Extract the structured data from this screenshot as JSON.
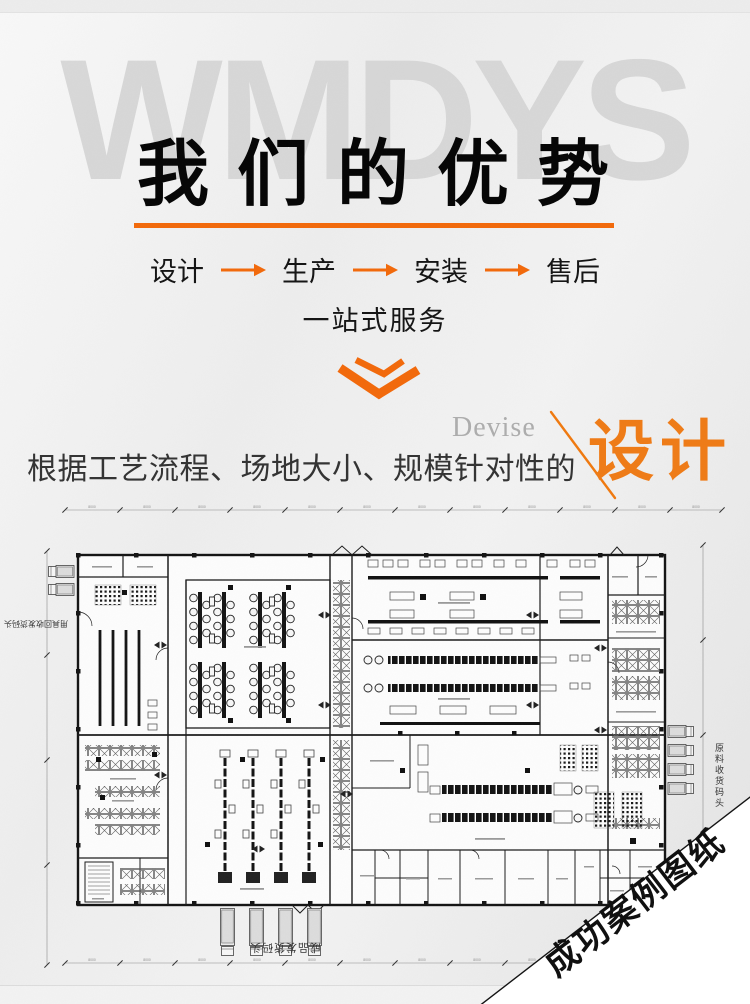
{
  "page": {
    "watermark": "WMDYS"
  },
  "header": {
    "title": "我 们 的 优 势"
  },
  "flow": {
    "steps": [
      "设计",
      "生产",
      "安装",
      "售后"
    ],
    "subtitle": "一站式服务"
  },
  "design_section": {
    "english": "Devise",
    "keyword": "设计",
    "description": "根据工艺流程、场地大小、规模针对性的"
  },
  "plan": {
    "dim_label": "8000",
    "docks": {
      "right": "原料收货码头",
      "left": "用具回收发货码头",
      "bottom": "成品发货码头"
    }
  },
  "ribbon": {
    "text": "成功案例图纸"
  },
  "colors": {
    "accent": "#f2690b",
    "keyword_orange": "#ef7b17",
    "watermark_gray": "#d3d3d3"
  }
}
